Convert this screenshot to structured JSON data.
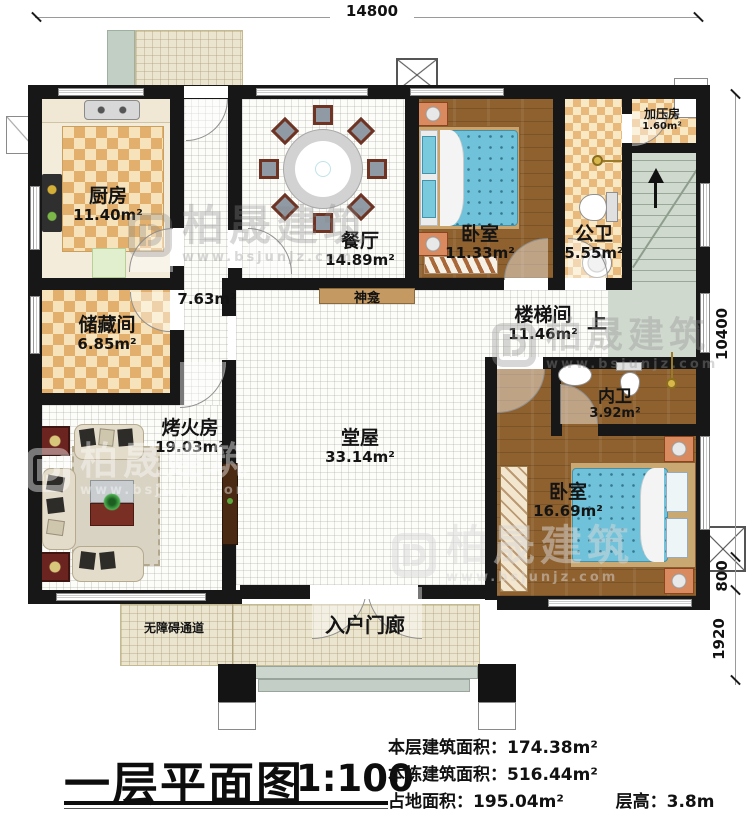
{
  "title_block": {
    "title": "一层平面图",
    "scale": "1:100"
  },
  "stats": {
    "floor_area_label": "本层建筑面积：",
    "floor_area": "174.38m²",
    "building_area_label": "本栋建筑面积：",
    "building_area": "516.44m²",
    "footprint_label": "占地面积：",
    "footprint": "195.04m²",
    "height_label": "层高：",
    "height": "3.8m"
  },
  "dimensions": {
    "top": "14800",
    "right_main": "10400",
    "right_porch": "800",
    "right_steps": "1920"
  },
  "rooms": {
    "kitchen": {
      "name": "厨房",
      "area": "11.40m²"
    },
    "dining": {
      "name": "餐厅",
      "area": "14.89m²"
    },
    "bedroom1": {
      "name": "卧室",
      "area": "11.33m²"
    },
    "public_bath": {
      "name": "公卫",
      "area": "5.55m²"
    },
    "pressure_room": {
      "name": "加压房",
      "area": "1.60m²"
    },
    "hallway": {
      "area": "7.63m²"
    },
    "storage": {
      "name": "储藏间",
      "area": "6.85m²"
    },
    "stair_hall": {
      "name": "楼梯间",
      "area": "11.46m²",
      "up": "上"
    },
    "fire_room": {
      "name": "烤火房",
      "area": "19.03m²"
    },
    "main_hall": {
      "name": "堂屋",
      "area": "33.14m²"
    },
    "private_bath": {
      "name": "内卫",
      "area": "3.92m²"
    },
    "bedroom2": {
      "name": "卧室",
      "area": "16.69m²"
    },
    "shrine": "神龛",
    "ramp": "无障碍通道",
    "porch": "入户门廊"
  },
  "watermark": {
    "name": "柏晟建筑",
    "url": "www.bsjunjz.com"
  },
  "colors": {
    "wall": "#171717",
    "checker_dark": "#e2b06c",
    "checker_light": "#f6e3bb",
    "wood": "#8f612e",
    "mattress_blue": "#6fc2da",
    "stairs_green": "#cfd9cd",
    "porch_beige": "#ebe4ce",
    "accent_red": "#6b2420"
  }
}
